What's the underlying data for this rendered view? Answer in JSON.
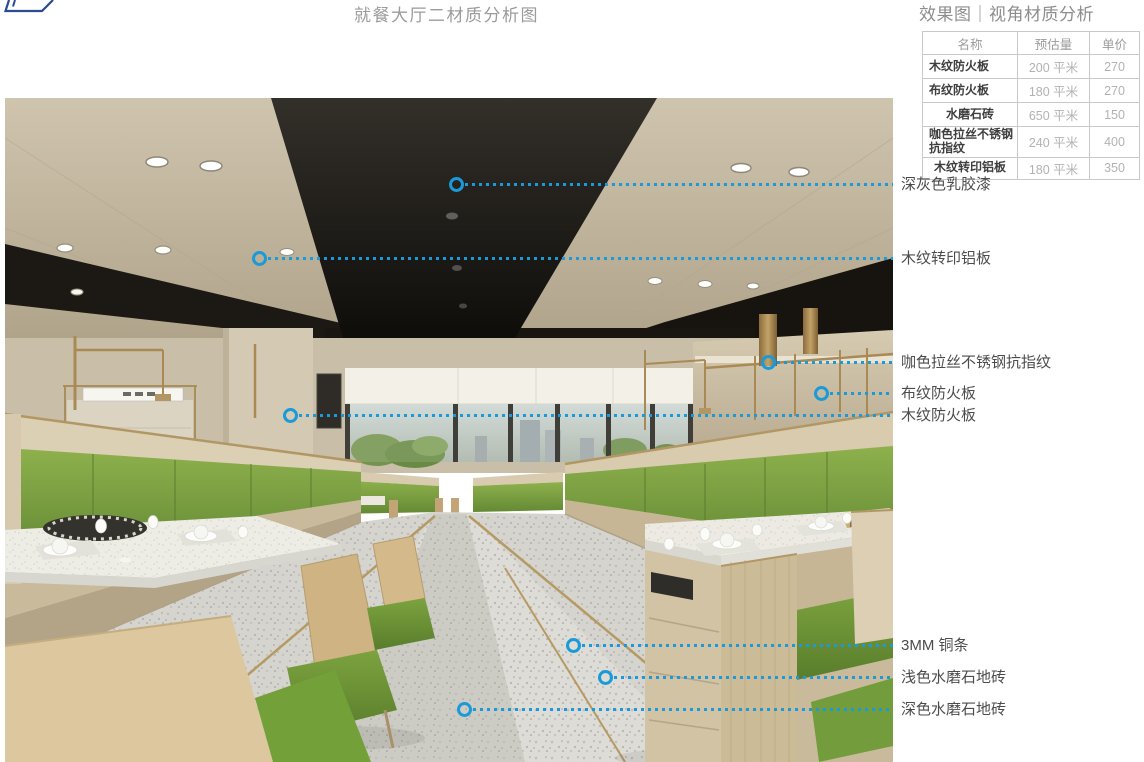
{
  "header": {
    "main_title": "就餐大厅二材质分析图",
    "panel_title": "效果图｜视角材质分析"
  },
  "materials_table": {
    "columns": [
      "名称",
      "预估量",
      "单价"
    ],
    "rows": [
      {
        "name": "木纹防火板",
        "qty": "200 平米",
        "price": "270"
      },
      {
        "name": "布纹防火板",
        "qty": "180 平米",
        "price": "270"
      },
      {
        "name": "水磨石砖",
        "qty": "650 平米",
        "price": "150"
      },
      {
        "name": "咖色拉丝不锈钢抗指纹",
        "qty": "240 平米",
        "price": "400"
      },
      {
        "name": "木纹转印铝板",
        "qty": "180 平米",
        "price": "350"
      }
    ]
  },
  "callouts": [
    {
      "label": "深灰色乳胶漆",
      "x": 456,
      "y": 184
    },
    {
      "label": "木纹转印铝板",
      "x": 259,
      "y": 258
    },
    {
      "label": "咖色拉丝不锈钢抗指纹",
      "x": 768,
      "y": 362
    },
    {
      "label": "布纹防火板",
      "x": 821,
      "y": 393
    },
    {
      "label": "木纹防火板",
      "x": 290,
      "y": 415
    },
    {
      "label": "3MM 铜条",
      "x": 573,
      "y": 645
    },
    {
      "label": "浅色水磨石地砖",
      "x": 605,
      "y": 677
    },
    {
      "label": "深色水磨石地砖",
      "x": 464,
      "y": 709
    }
  ],
  "colors": {
    "callout_blue": "#1a9ad8",
    "title_gray": "#9b9b9b",
    "label_gray": "#4c4c4c",
    "table_border": "#c9c9c9",
    "ceiling_wood": "#c3b69e",
    "ceiling_dark": "#1d1a16",
    "booth_green": "#7ea23c",
    "brass": "#a98a55",
    "floor_terrazzo": "#d6d5d1",
    "logo_navy": "#2a4b8f"
  },
  "scene": {
    "description": "dining-hall-interior-rendering"
  }
}
